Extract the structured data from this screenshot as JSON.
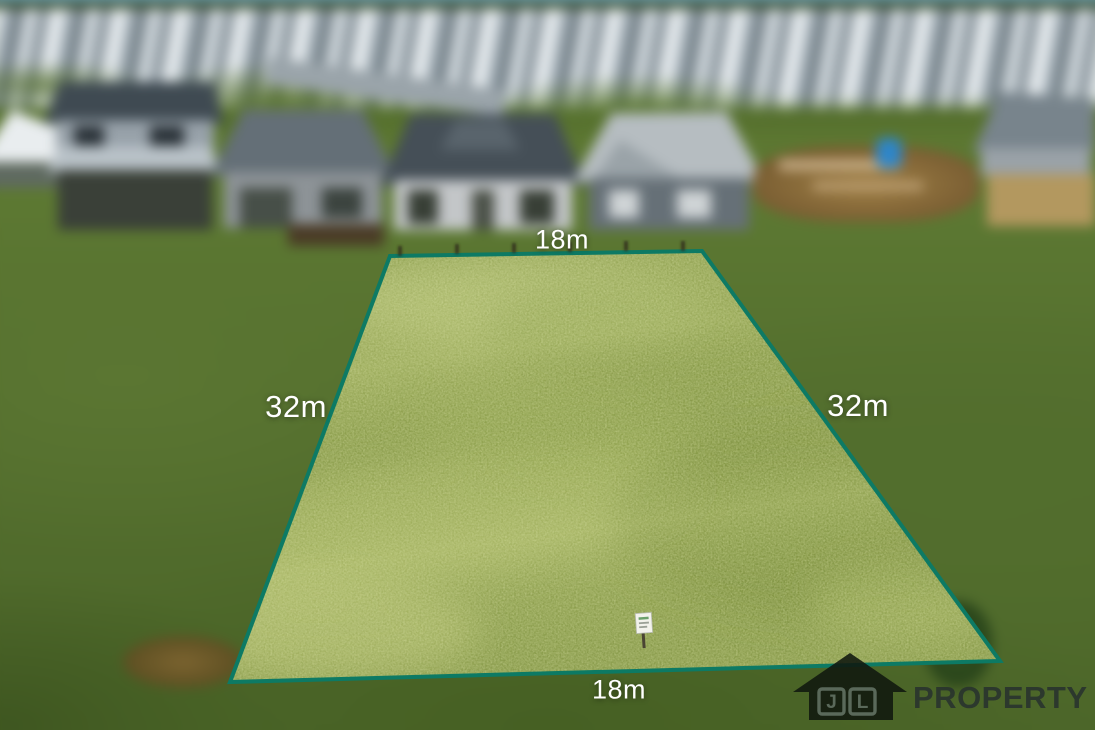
{
  "photo": {
    "description": "Aerial drone photo of a vacant grass residential lot outlined for sale, blurred suburban houses behind",
    "dimension_labels": {
      "top": "18m",
      "left": "32m",
      "right": "32m",
      "bottom": "18m"
    },
    "boundary_color": "#0d7a64",
    "label_color": "#ffffff",
    "lot_grass_color": "#8a9c4c",
    "surrounding_grass_color": "#546f2e"
  },
  "watermark": {
    "initial_1": "J",
    "initial_2": "L",
    "brand_text": "PROPERTY",
    "icon_color": "#10180f",
    "text_color": "#28322d"
  }
}
